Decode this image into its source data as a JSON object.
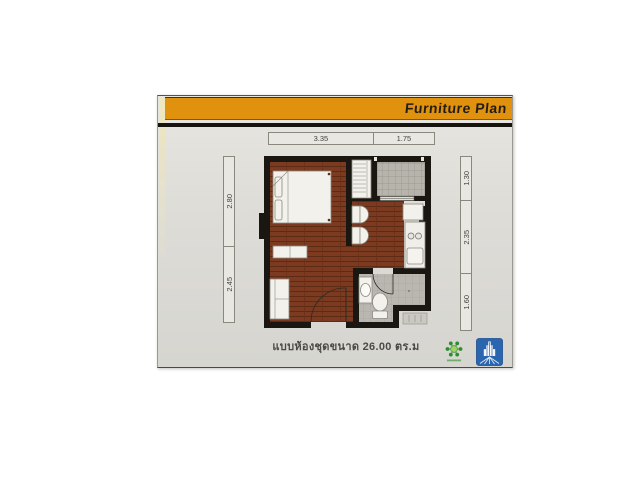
{
  "header": {
    "title": "Furniture Plan"
  },
  "colors": {
    "accent_orange": "#e0920f",
    "wall_black": "#1a1712",
    "wood_brown": "#7c3b20",
    "card_background": "#dddcd7",
    "tile_gray": "#b6b4ab",
    "logo_green": "#2e8b2e",
    "logo_blue": "#2a66b0"
  },
  "dimensions": {
    "top": [
      {
        "label": "3.35"
      },
      {
        "label": "1.75"
      }
    ],
    "left": [
      {
        "label": "2.80"
      },
      {
        "label": "2.45"
      }
    ],
    "right": [
      {
        "label": "1.30"
      },
      {
        "label": "2.35"
      },
      {
        "label": "1.60"
      }
    ]
  },
  "caption": {
    "text": "แบบห้องชุดขนาด 26.00 ตร.ม",
    "area_sqm": "26.00"
  },
  "logos": {
    "green": "community-molecule-logo",
    "blue": "building-tower-logo"
  }
}
